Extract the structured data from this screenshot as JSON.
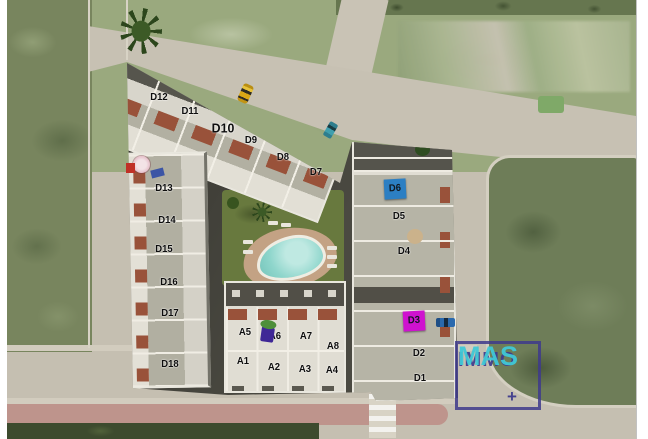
{
  "scene": {
    "type": "residential-development-site-plan",
    "colors": {
      "highlight_blue": "#2c7fc3",
      "highlight_magenta": "#cf12cf",
      "logo_navy": "#3d3a8f",
      "logo_teal": "#3fc9d6",
      "pool_water": "#8fd6cc"
    }
  },
  "unit_labels": [
    {
      "id": "D12",
      "x": 159,
      "y": 98
    },
    {
      "id": "D11",
      "x": 190,
      "y": 112
    },
    {
      "id": "D10",
      "x": 223,
      "y": 128,
      "size": "lg"
    },
    {
      "id": "D9",
      "x": 251,
      "y": 141
    },
    {
      "id": "D8",
      "x": 283,
      "y": 158
    },
    {
      "id": "D7",
      "x": 316,
      "y": 173
    },
    {
      "id": "D13",
      "x": 164,
      "y": 189
    },
    {
      "id": "D14",
      "x": 167,
      "y": 221
    },
    {
      "id": "D15",
      "x": 164,
      "y": 250
    },
    {
      "id": "D16",
      "x": 169,
      "y": 283
    },
    {
      "id": "D17",
      "x": 170,
      "y": 314
    },
    {
      "id": "D18",
      "x": 170,
      "y": 365
    },
    {
      "id": "D6",
      "x": 395,
      "y": 189,
      "highlight": "blue"
    },
    {
      "id": "D5",
      "x": 399,
      "y": 217
    },
    {
      "id": "D4",
      "x": 404,
      "y": 252
    },
    {
      "id": "D3",
      "x": 414,
      "y": 321,
      "highlight": "magenta"
    },
    {
      "id": "D2",
      "x": 419,
      "y": 354
    },
    {
      "id": "D1",
      "x": 420,
      "y": 379
    },
    {
      "id": "A5",
      "x": 245,
      "y": 333
    },
    {
      "id": "A6",
      "x": 275,
      "y": 337
    },
    {
      "id": "A7",
      "x": 306,
      "y": 337
    },
    {
      "id": "A8",
      "x": 333,
      "y": 347
    },
    {
      "id": "A1",
      "x": 243,
      "y": 362
    },
    {
      "id": "A2",
      "x": 274,
      "y": 368
    },
    {
      "id": "A3",
      "x": 305,
      "y": 370
    },
    {
      "id": "A4",
      "x": 332,
      "y": 371
    }
  ],
  "logo": {
    "line1": "IMMO",
    "line2": "MAS",
    "plus": "+"
  }
}
